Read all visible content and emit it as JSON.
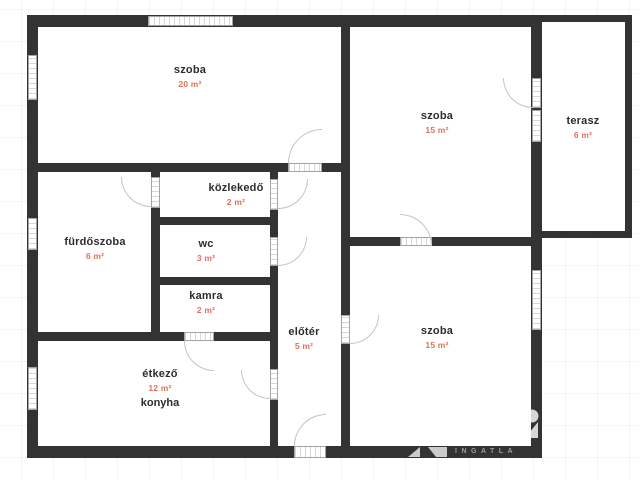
{
  "plan": {
    "rooms": [
      {
        "id": "szoba-1",
        "name": "szoba",
        "area": "20 m²"
      },
      {
        "id": "szoba-2",
        "name": "szoba",
        "area": "15 m²"
      },
      {
        "id": "terasz",
        "name": "terasz",
        "area": "6 m²"
      },
      {
        "id": "furdoszoba",
        "name": "fürdőszoba",
        "area": "6 m²"
      },
      {
        "id": "kozlekedo",
        "name": "közlekedő",
        "area": "2 m²"
      },
      {
        "id": "wc",
        "name": "wc",
        "area": "3 m²"
      },
      {
        "id": "kamra",
        "name": "kamra",
        "area": "2 m²"
      },
      {
        "id": "eloter",
        "name": "előtér",
        "area": "5 m²"
      },
      {
        "id": "szoba-3",
        "name": "szoba",
        "area": "15 m²"
      },
      {
        "id": "etkezo-konyha",
        "name": "étkező",
        "area": "12 m²",
        "secondary_name": "konyha"
      }
    ]
  },
  "watermark": {
    "text": "INGATLA"
  },
  "colors": {
    "wall": "#333333",
    "room_text": "#2d2d2d",
    "area_text": "#e0705a",
    "door_arc": "#c4c4c4"
  }
}
